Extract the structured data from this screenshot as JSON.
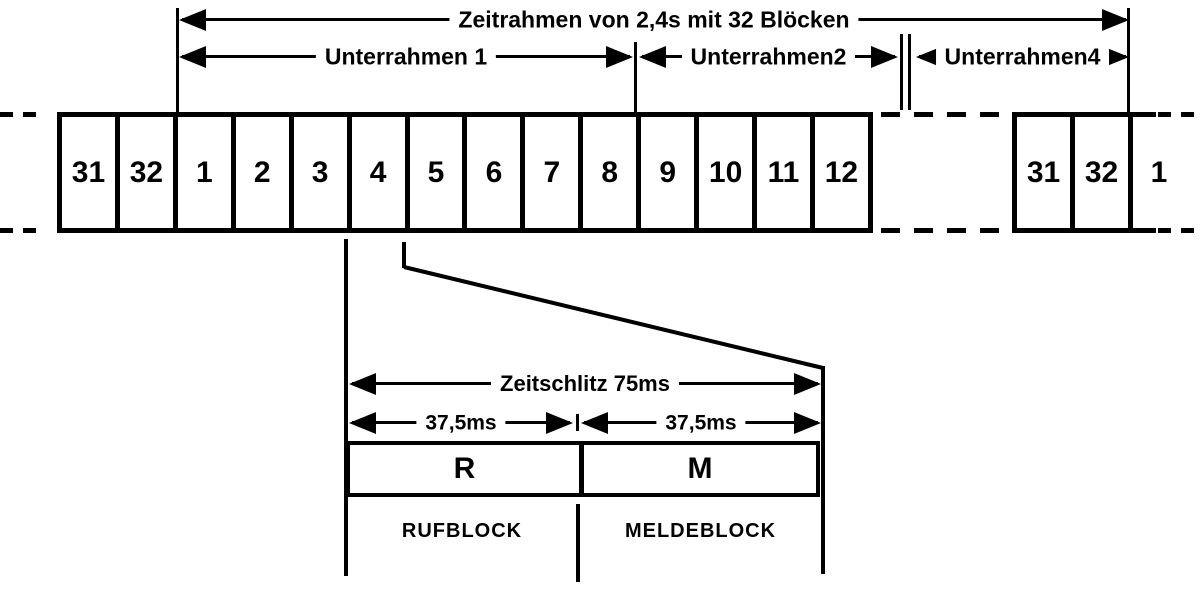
{
  "frame": {
    "title": "Zeitrahmen von 2,4s mit 32 Blöcken",
    "subframes": [
      {
        "label": "Unterrahmen 1"
      },
      {
        "label": "Unterrahmen2"
      },
      {
        "label": "Unterrahmen4"
      }
    ]
  },
  "blocks": {
    "main": [
      "31",
      "32",
      "1",
      "2",
      "3",
      "4",
      "5",
      "6",
      "7",
      "8",
      "9",
      "10",
      "11",
      "12"
    ],
    "right": [
      "31",
      "32"
    ],
    "right_open": "1"
  },
  "timeslot": {
    "title": "Zeitschlitz 75ms",
    "half_left": "37,5ms",
    "half_right": "37,5ms",
    "r_label": "R",
    "m_label": "M",
    "rufblock": "RUFBLOCK",
    "meldeblock": "MELDEBLOCK"
  },
  "colors": {
    "ink": "#000000",
    "background": "#ffffff"
  }
}
